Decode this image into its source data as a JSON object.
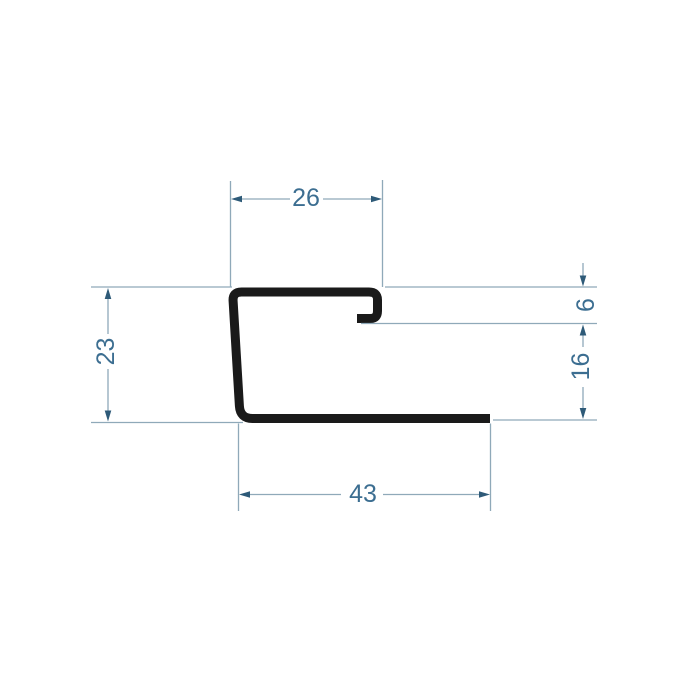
{
  "drawing": {
    "description": "Technical cross-section drawing of a J-shaped metal edge profile with dimension lines",
    "dimensions": {
      "top_width": "26",
      "left_height": "23",
      "hook_depth": "6",
      "right_opening": "16",
      "bottom_width": "43"
    }
  },
  "colors": {
    "background": "#ffffff",
    "profile": "#1a1a1a",
    "dim_line": "#8fa9b9",
    "arrow": "#2e5a78",
    "text": "#3c6e91"
  }
}
